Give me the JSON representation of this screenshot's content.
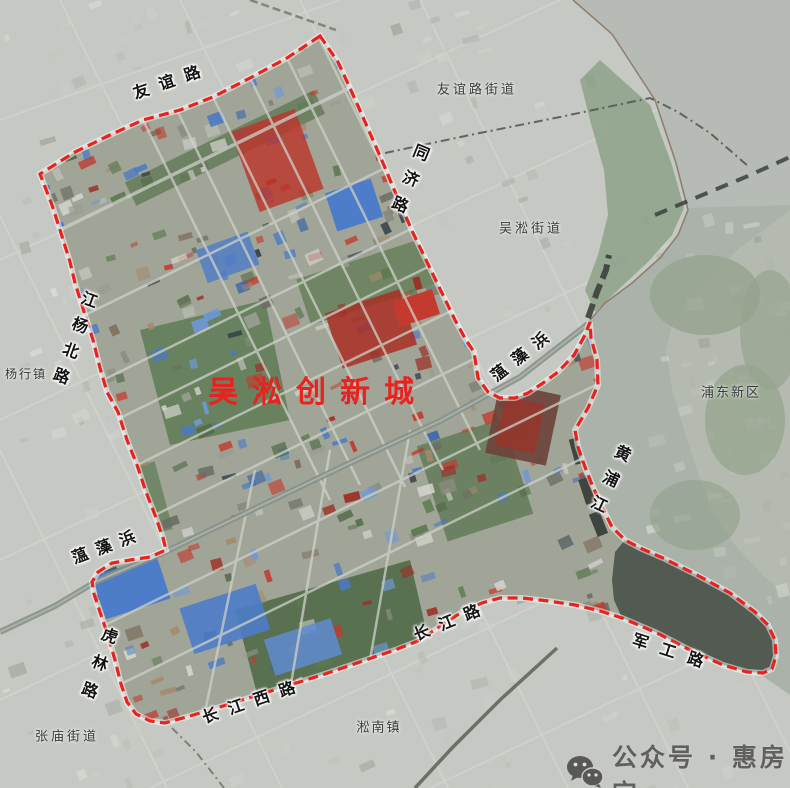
{
  "map": {
    "title": {
      "text": "吴淞创新城",
      "x": 318,
      "y": 389
    },
    "labels": [
      {
        "name": "youyi-road",
        "text": "友谊路",
        "x": 172,
        "y": 81,
        "rot": -19,
        "dir": "h",
        "ls": 11,
        "size": 16,
        "type": "road"
      },
      {
        "name": "youyi-road-subdistrict",
        "text": "友谊路街道",
        "x": 477,
        "y": 90,
        "rot": 0,
        "dir": "h",
        "ls": 3,
        "size": 13,
        "type": "place"
      },
      {
        "name": "tongji-road",
        "text": "同济路",
        "x": 407,
        "y": 183,
        "rot": 22,
        "dir": "v",
        "ls": 12,
        "size": 16,
        "type": "road"
      },
      {
        "name": "wusong-subdistrict",
        "text": "吴淞街道",
        "x": 531,
        "y": 229,
        "rot": 0,
        "dir": "h",
        "ls": 3,
        "size": 13,
        "type": "place"
      },
      {
        "name": "jiangyang-north-road",
        "text": "江杨北路",
        "x": 72,
        "y": 342,
        "rot": 20,
        "dir": "v",
        "ls": 11,
        "size": 16,
        "type": "road"
      },
      {
        "name": "yanghang-town",
        "text": "杨行镇",
        "x": 26,
        "y": 374,
        "rot": 0,
        "dir": "h",
        "ls": 2,
        "size": 12,
        "type": "place"
      },
      {
        "name": "wenzaobang-northeast",
        "text": "蕰藻浜",
        "x": 524,
        "y": 354,
        "rot": -38,
        "dir": "h",
        "ls": 10,
        "size": 16,
        "type": "road"
      },
      {
        "name": "pudong-new-district",
        "text": "浦东新区",
        "x": 731,
        "y": 393,
        "rot": 0,
        "dir": "h",
        "ls": 2,
        "size": 13,
        "type": "place"
      },
      {
        "name": "huangpu-river",
        "text": "黄浦江",
        "x": 607,
        "y": 483,
        "rot": 25,
        "dir": "v",
        "ls": 12,
        "size": 16,
        "type": "road"
      },
      {
        "name": "wenzaobang-southwest",
        "text": "蕰藻浜",
        "x": 108,
        "y": 546,
        "rot": -20,
        "dir": "h",
        "ls": 9,
        "size": 16,
        "type": "road"
      },
      {
        "name": "hulin-road",
        "text": "虎林路",
        "x": 96,
        "y": 668,
        "rot": 20,
        "dir": "v",
        "ls": 13,
        "size": 16,
        "type": "road"
      },
      {
        "name": "changjiang-west-road",
        "text": "长江西路",
        "x": 254,
        "y": 701,
        "rot": -19,
        "dir": "h",
        "ls": 11,
        "size": 16,
        "type": "road"
      },
      {
        "name": "zhangmiao-subdistrict",
        "text": "张庙街道",
        "x": 67,
        "y": 737,
        "rot": 0,
        "dir": "h",
        "ls": 3,
        "size": 13,
        "type": "place"
      },
      {
        "name": "songnan-town",
        "text": "淞南镇",
        "x": 379,
        "y": 728,
        "rot": 0,
        "dir": "h",
        "ls": 2,
        "size": 13,
        "type": "place"
      },
      {
        "name": "changjiang-road",
        "text": "长江路",
        "x": 452,
        "y": 621,
        "rot": -22,
        "dir": "h",
        "ls": 11,
        "size": 16,
        "type": "road"
      },
      {
        "name": "jungong-road",
        "text": "军工路",
        "x": 674,
        "y": 653,
        "rot": 18,
        "dir": "h",
        "ls": 13,
        "size": 16,
        "type": "road"
      }
    ],
    "watermark": {
      "text": "公众号 · 惠房宝",
      "icon": "wechat-icon"
    },
    "colors": {
      "boundary": "#e8231f",
      "title": "#e8231f",
      "road_label": "#141414",
      "place_label": "#383d3a",
      "water": "#aab2aa",
      "estuary": "#b7bdb6",
      "watermark": "#474747"
    }
  }
}
